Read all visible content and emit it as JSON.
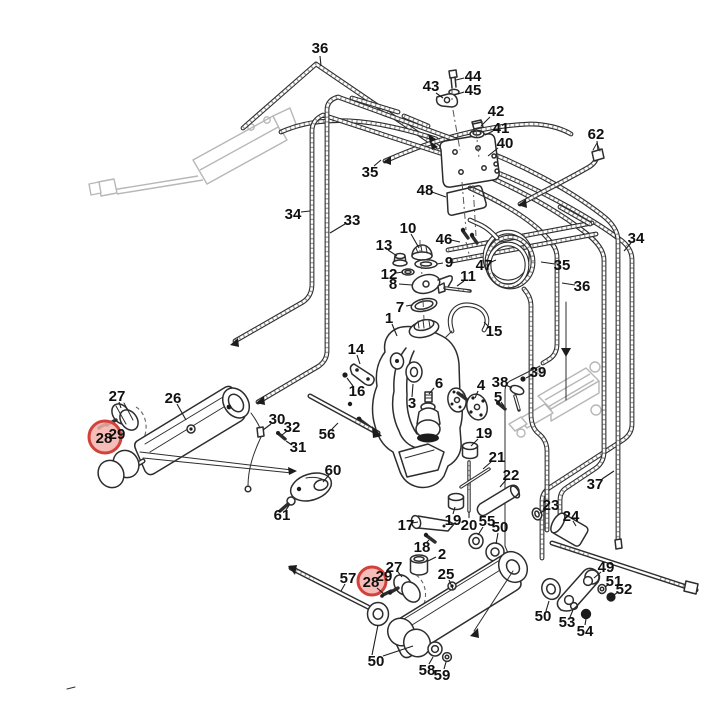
{
  "meta": {
    "background": "#ffffff",
    "line_color": "#2d2d2d",
    "highlight_fill": "#f5b0aa",
    "highlight_ring": "#d2423b",
    "label_color": "#101010",
    "diagram_type": "exploded-parts-diagram",
    "highlighted_parts": [
      "28"
    ]
  },
  "callouts": [
    {
      "n": "36",
      "x": 320,
      "y": 48,
      "l": [
        [
          320,
          56,
          321,
          66
        ]
      ]
    },
    {
      "n": "43",
      "x": 431,
      "y": 86,
      "l": [
        [
          436,
          93,
          443,
          98
        ]
      ]
    },
    {
      "n": "44",
      "x": 473,
      "y": 76,
      "l": [
        [
          464,
          78,
          456,
          80
        ]
      ]
    },
    {
      "n": "45",
      "x": 473,
      "y": 90,
      "l": [
        [
          464,
          92,
          458,
          94
        ]
      ]
    },
    {
      "n": "42",
      "x": 496,
      "y": 111,
      "l": [
        [
          490,
          117,
          481,
          126
        ]
      ]
    },
    {
      "n": "41",
      "x": 501,
      "y": 128,
      "l": [
        [
          493,
          131,
          485,
          135
        ]
      ]
    },
    {
      "n": "40",
      "x": 505,
      "y": 143,
      "l": [
        [
          498,
          148,
          488,
          156
        ]
      ]
    },
    {
      "n": "62",
      "x": 596,
      "y": 134,
      "l": [
        [
          597,
          141,
          598,
          150
        ]
      ]
    },
    {
      "n": "35",
      "x": 370,
      "y": 172,
      "l": [
        [
          374,
          166,
          381,
          160
        ]
      ]
    },
    {
      "n": "48",
      "x": 425,
      "y": 190,
      "l": [
        [
          432,
          192,
          446,
          197
        ]
      ]
    },
    {
      "n": "34",
      "x": 293,
      "y": 214,
      "l": [
        [
          301,
          212,
          310,
          211
        ]
      ]
    },
    {
      "n": "33",
      "x": 352,
      "y": 220,
      "l": [
        [
          345,
          224,
          330,
          233
        ]
      ]
    },
    {
      "n": "10",
      "x": 408,
      "y": 228,
      "l": [
        [
          411,
          234,
          419,
          248
        ]
      ]
    },
    {
      "n": "13",
      "x": 384,
      "y": 245,
      "l": [
        [
          388,
          250,
          397,
          256
        ]
      ]
    },
    {
      "n": "9",
      "x": 449,
      "y": 262,
      "l": [
        [
          443,
          263,
          437,
          264
        ]
      ]
    },
    {
      "n": "12",
      "x": 389,
      "y": 274,
      "l": [
        [
          396,
          273,
          403,
          272
        ]
      ]
    },
    {
      "n": "8",
      "x": 393,
      "y": 284,
      "l": [
        [
          399,
          284,
          412,
          285
        ]
      ]
    },
    {
      "n": "11",
      "x": 468,
      "y": 276,
      "l": [
        [
          464,
          281,
          457,
          286
        ]
      ]
    },
    {
      "n": "7",
      "x": 400,
      "y": 307,
      "l": [
        [
          406,
          306,
          412,
          305
        ]
      ]
    },
    {
      "n": "1",
      "x": 389,
      "y": 318,
      "l": [
        [
          392,
          324,
          397,
          336
        ]
      ]
    },
    {
      "n": "15",
      "x": 494,
      "y": 331,
      "l": [
        [
          489,
          327,
          484,
          322
        ]
      ]
    },
    {
      "n": "46",
      "x": 444,
      "y": 239,
      "l": [
        [
          451,
          240,
          460,
          242
        ]
      ]
    },
    {
      "n": "47",
      "x": 484,
      "y": 265,
      "l": [
        [
          489,
          263,
          496,
          260
        ]
      ]
    },
    {
      "n": "34",
      "x": 636,
      "y": 238,
      "l": [
        [
          631,
          243,
          624,
          251
        ]
      ]
    },
    {
      "n": "35",
      "x": 562,
      "y": 265,
      "l": [
        [
          555,
          264,
          541,
          262
        ]
      ]
    },
    {
      "n": "36",
      "x": 582,
      "y": 286,
      "l": [
        [
          575,
          285,
          562,
          283
        ]
      ]
    },
    {
      "n": "14",
      "x": 356,
      "y": 349,
      "l": [
        [
          357,
          355,
          360,
          364
        ]
      ]
    },
    {
      "n": "16",
      "x": 357,
      "y": 391,
      "l": [
        [
          353,
          386,
          347,
          378
        ]
      ]
    },
    {
      "n": "27",
      "x": 117,
      "y": 396,
      "l": [
        [
          119,
          402,
          121,
          408
        ]
      ]
    },
    {
      "n": "26",
      "x": 173,
      "y": 398,
      "l": [
        [
          177,
          404,
          186,
          420
        ]
      ]
    },
    {
      "n": "28",
      "x": 104,
      "y": 438,
      "red": true,
      "r": 16
    },
    {
      "n": "29",
      "x": 117,
      "y": 434
    },
    {
      "n": "30",
      "x": 277,
      "y": 419,
      "l": [
        [
          271,
          424,
          263,
          430
        ]
      ]
    },
    {
      "n": "32",
      "x": 292,
      "y": 427,
      "l": [
        [
          287,
          431,
          282,
          435
        ]
      ]
    },
    {
      "n": "31",
      "x": 298,
      "y": 447,
      "l": [
        [
          292,
          445,
          286,
          441
        ]
      ]
    },
    {
      "n": "56",
      "x": 327,
      "y": 434,
      "l": [
        [
          332,
          429,
          338,
          423
        ]
      ]
    },
    {
      "n": "60",
      "x": 333,
      "y": 470,
      "l": [
        [
          329,
          475,
          323,
          482
        ]
      ]
    },
    {
      "n": "61",
      "x": 282,
      "y": 515,
      "l": [
        [
          286,
          510,
          290,
          504
        ]
      ]
    },
    {
      "n": "6",
      "x": 439,
      "y": 383,
      "l": [
        [
          434,
          388,
          429,
          394
        ]
      ]
    },
    {
      "n": "3",
      "x": 412,
      "y": 403,
      "l": [
        [
          412,
          397,
          413,
          384
        ]
      ]
    },
    {
      "n": "4",
      "x": 481,
      "y": 385,
      "l": [
        [
          478,
          391,
          475,
          398
        ]
      ]
    },
    {
      "n": "38",
      "x": 500,
      "y": 382,
      "l": [
        [
          506,
          385,
          512,
          388
        ]
      ]
    },
    {
      "n": "39",
      "x": 538,
      "y": 372,
      "l": [
        [
          532,
          375,
          526,
          378
        ]
      ]
    },
    {
      "n": "5",
      "x": 498,
      "y": 397,
      "l": [
        [
          501,
          402,
          504,
          406
        ]
      ]
    },
    {
      "n": "19",
      "x": 484,
      "y": 433,
      "l": [
        [
          478,
          439,
          471,
          446
        ]
      ]
    },
    {
      "n": "21",
      "x": 497,
      "y": 457,
      "l": [
        [
          491,
          462,
          483,
          469
        ]
      ]
    },
    {
      "n": "22",
      "x": 511,
      "y": 475,
      "l": [
        [
          506,
          480,
          500,
          487
        ]
      ]
    },
    {
      "n": "37",
      "x": 595,
      "y": 484,
      "l": [
        [
          602,
          479,
          614,
          471
        ]
      ]
    },
    {
      "n": "23",
      "x": 551,
      "y": 505,
      "l": [
        [
          547,
          509,
          540,
          513
        ]
      ]
    },
    {
      "n": "24",
      "x": 571,
      "y": 516,
      "l": [
        [
          573,
          521,
          576,
          526
        ]
      ]
    },
    {
      "n": "17",
      "x": 406,
      "y": 525,
      "l": [
        [
          412,
          523,
          418,
          522
        ]
      ]
    },
    {
      "n": "19",
      "x": 453,
      "y": 520,
      "l": [
        [
          453,
          514,
          455,
          507
        ]
      ]
    },
    {
      "n": "20",
      "x": 469,
      "y": 525,
      "l": [
        [
          469,
          518,
          469,
          512
        ]
      ]
    },
    {
      "n": "55",
      "x": 487,
      "y": 521,
      "l": [
        [
          483,
          527,
          478,
          535
        ]
      ]
    },
    {
      "n": "50",
      "x": 500,
      "y": 527,
      "l": [
        [
          498,
          533,
          496,
          544
        ]
      ]
    },
    {
      "n": "18",
      "x": 422,
      "y": 547,
      "l": [
        [
          426,
          543,
          429,
          540
        ]
      ]
    },
    {
      "n": "2",
      "x": 442,
      "y": 554,
      "l": [
        [
          436,
          557,
          428,
          561
        ]
      ]
    },
    {
      "n": "27",
      "x": 394,
      "y": 567,
      "l": [
        [
          398,
          572,
          402,
          577
        ]
      ]
    },
    {
      "n": "29",
      "x": 384,
      "y": 576
    },
    {
      "n": "28",
      "x": 371,
      "y": 582,
      "red": true,
      "r": 14,
      "l": [
        [
          377,
          588,
          384,
          594
        ]
      ]
    },
    {
      "n": "25",
      "x": 446,
      "y": 574,
      "l": [
        [
          449,
          580,
          453,
          589
        ]
      ]
    },
    {
      "n": "57",
      "x": 348,
      "y": 578,
      "l": [
        [
          345,
          584,
          341,
          591
        ]
      ]
    },
    {
      "n": "49",
      "x": 606,
      "y": 567,
      "l": [
        [
          601,
          572,
          594,
          578
        ]
      ]
    },
    {
      "n": "51",
      "x": 614,
      "y": 581,
      "l": [
        [
          609,
          584,
          605,
          587
        ]
      ]
    },
    {
      "n": "52",
      "x": 624,
      "y": 589,
      "l": [
        [
          618,
          592,
          614,
          595
        ]
      ]
    },
    {
      "n": "50",
      "x": 543,
      "y": 616,
      "l": [
        [
          546,
          611,
          549,
          601
        ]
      ]
    },
    {
      "n": "53",
      "x": 567,
      "y": 622,
      "l": [
        [
          570,
          617,
          573,
          610
        ]
      ]
    },
    {
      "n": "54",
      "x": 585,
      "y": 631,
      "l": [
        [
          585,
          625,
          586,
          619
        ]
      ]
    },
    {
      "n": "50",
      "x": 376,
      "y": 661,
      "l": [
        [
          372,
          655,
          378,
          625
        ],
        [
          383,
          656,
          413,
          646
        ]
      ]
    },
    {
      "n": "58",
      "x": 427,
      "y": 670,
      "l": [
        [
          429,
          664,
          433,
          657
        ]
      ]
    },
    {
      "n": "59",
      "x": 442,
      "y": 675,
      "l": [
        [
          444,
          669,
          446,
          662
        ]
      ]
    }
  ]
}
